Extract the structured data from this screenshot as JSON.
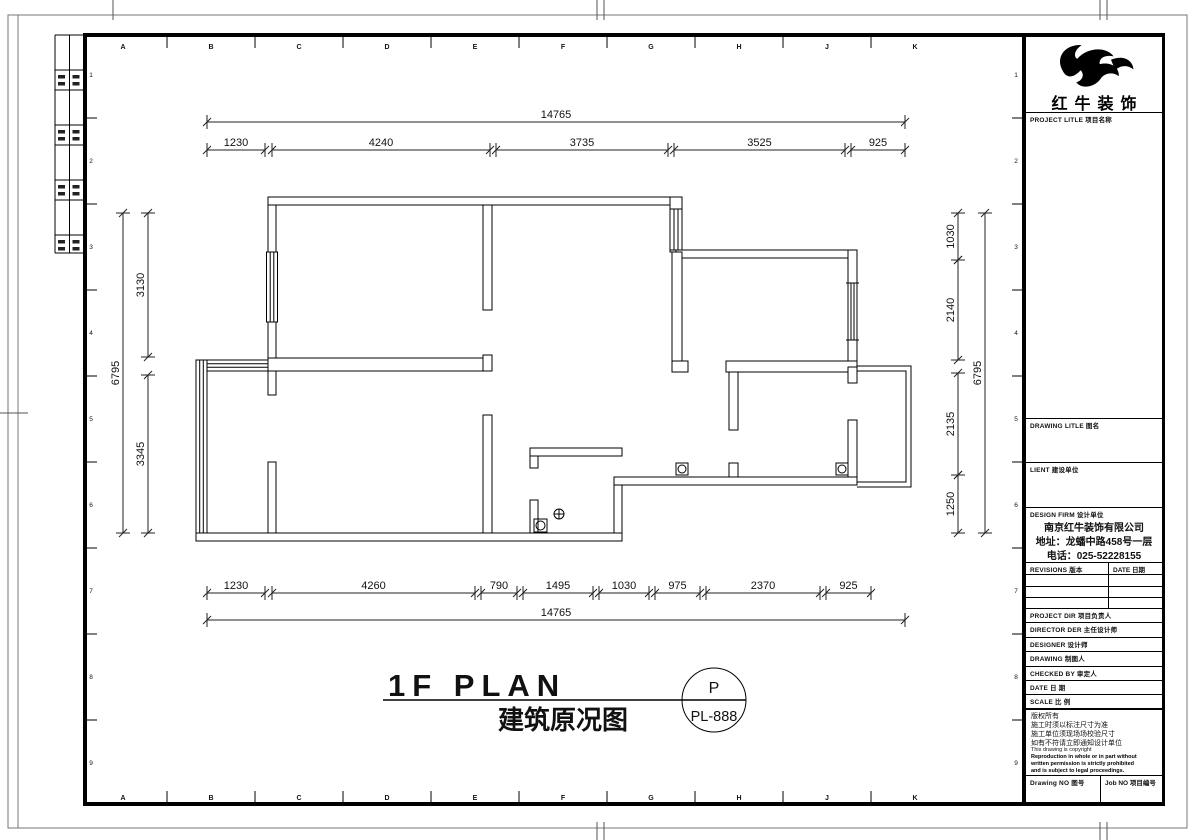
{
  "sheet": {
    "grid_letters": [
      "A",
      "B",
      "C",
      "D",
      "E",
      "F",
      "G",
      "H",
      "J",
      "K"
    ],
    "grid_numbers": [
      "1",
      "2",
      "3",
      "4",
      "5",
      "6",
      "7",
      "8",
      "9"
    ]
  },
  "plan": {
    "title_en": "1F PLAN",
    "title_cn": "建筑原况图",
    "badge_letter": "P",
    "badge_code": "PL-888",
    "dims": [
      {
        "o": "h",
        "y": 122,
        "x1": 207,
        "x2": 905,
        "label": "14765"
      },
      {
        "o": "h",
        "y": 150,
        "x1": 207,
        "x2": 265,
        "label": "1230"
      },
      {
        "o": "h",
        "y": 150,
        "x1": 272,
        "x2": 490,
        "label": "4240"
      },
      {
        "o": "h",
        "y": 150,
        "x1": 496,
        "x2": 668,
        "label": "3735"
      },
      {
        "o": "h",
        "y": 150,
        "x1": 674,
        "x2": 845,
        "label": "3525"
      },
      {
        "o": "h",
        "y": 150,
        "x1": 851,
        "x2": 905,
        "label": "925"
      },
      {
        "o": "h",
        "y": 593,
        "x1": 207,
        "x2": 265,
        "label": "1230"
      },
      {
        "o": "h",
        "y": 593,
        "x1": 272,
        "x2": 475,
        "label": "4260"
      },
      {
        "o": "h",
        "y": 593,
        "x1": 481,
        "x2": 517,
        "label": "790"
      },
      {
        "o": "h",
        "y": 593,
        "x1": 523,
        "x2": 593,
        "label": "1495"
      },
      {
        "o": "h",
        "y": 593,
        "x1": 599,
        "x2": 649,
        "label": "1030"
      },
      {
        "o": "h",
        "y": 593,
        "x1": 655,
        "x2": 700,
        "label": "975"
      },
      {
        "o": "h",
        "y": 593,
        "x1": 706,
        "x2": 820,
        "label": "2370"
      },
      {
        "o": "h",
        "y": 593,
        "x1": 826,
        "x2": 871,
        "label": "925"
      },
      {
        "o": "h",
        "y": 620,
        "x1": 207,
        "x2": 905,
        "label": "14765"
      },
      {
        "o": "v",
        "x": 123,
        "y1": 213,
        "y2": 533,
        "label": "6795"
      },
      {
        "o": "v",
        "x": 148,
        "y1": 213,
        "y2": 357,
        "label": "3130"
      },
      {
        "o": "v",
        "x": 148,
        "y1": 375,
        "y2": 533,
        "label": "3345"
      },
      {
        "o": "v",
        "x": 958,
        "y1": 213,
        "y2": 260,
        "label": "1030"
      },
      {
        "o": "v",
        "x": 958,
        "y1": 260,
        "y2": 360,
        "label": "2140"
      },
      {
        "o": "v",
        "x": 958,
        "y1": 373,
        "y2": 475,
        "label": "2135"
      },
      {
        "o": "v",
        "x": 958,
        "y1": 475,
        "y2": 533,
        "label": "1250"
      },
      {
        "o": "v",
        "x": 985,
        "y1": 213,
        "y2": 533,
        "label": "6795"
      }
    ]
  },
  "titleblock": {
    "brand": "红牛装饰",
    "project_title_label": "PROJECT LITLE  项目名称",
    "drawing_title_label": "DRAWING LITLE  图名",
    "client_label": "LIENT  建设单位",
    "design_firm_label": "DESIGN FIRM  设计单位",
    "firm_name": "南京红牛装饰有限公司",
    "firm_address": "地址：龙蟠中路458号一层",
    "firm_phone": "电话：025-52228155",
    "revisions_label": "REVISIONS  版本",
    "rev_date_label": "DATE  日期",
    "project_dir_label": "PROJECT DIR  项目负责人",
    "director_label": "DIRECTOR DER  主任设计师",
    "designer_label": "DESIGNER  设计师",
    "drawing_label": "DRAWING  制图人",
    "checked_label": "CHECKED BY  审定人",
    "date_label": "DATE  日 期",
    "scale_label": "SCALE  比 例",
    "notes": [
      "版权所有",
      "施工时须以标注尺寸为准",
      "施工单位须现场场校验尺寸",
      "如有不符请立即通知设计单位",
      "This drawing is copyright"
    ],
    "notes_bold": [
      "Reproduction in whole or in part without",
      "written permission is strictly prohibited",
      "and is subject to legal proceedings."
    ],
    "drawing_no_label": "Drawing NO  图号",
    "job_no_label": "Job NO  项目编号"
  }
}
